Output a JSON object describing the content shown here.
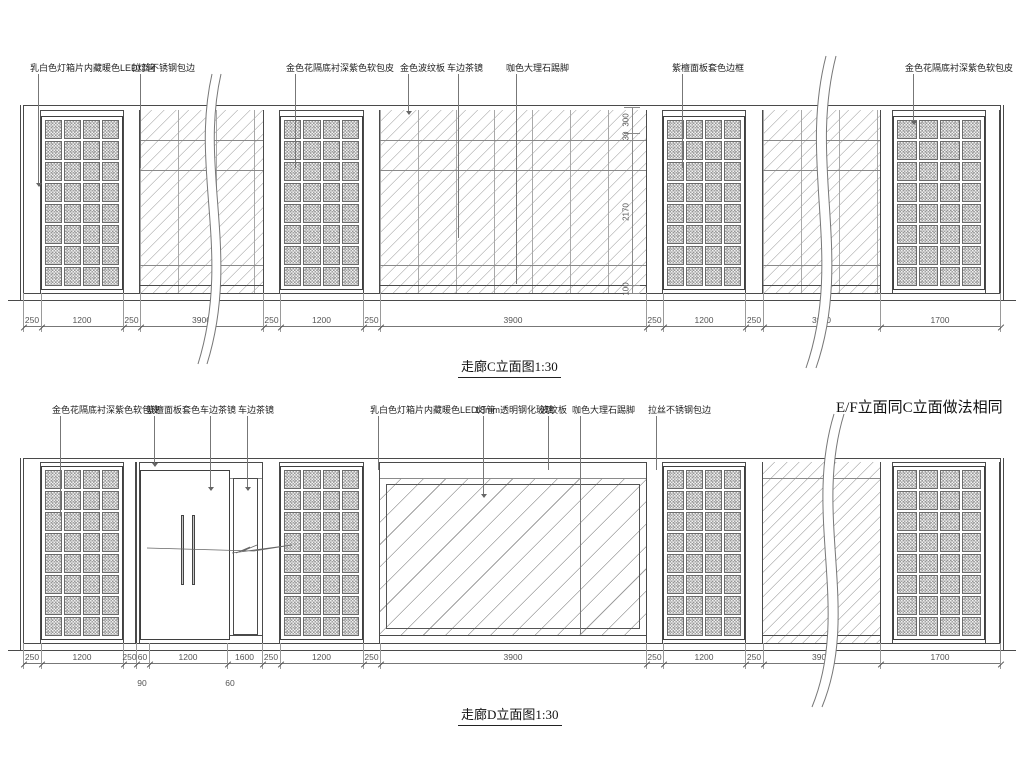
{
  "note_ef": "E/F立面同C立面做法相同",
  "drawing_c": {
    "title": "走廊C立面图1:30",
    "labels": [
      "乳白色灯箱片内藏暖色LED灯管",
      "拉丝不锈钢包边",
      "金色花隔底衬深紫色软包皮",
      "金色波纹板",
      "车边茶镜",
      "咖色大理石踢脚",
      "紫檀面板套色边框",
      "金色花隔底衬深紫色软包皮"
    ],
    "dims": [
      "250",
      "1200",
      "250",
      "3900",
      "250",
      "1200",
      "250",
      "3900",
      "250",
      "1200",
      "250",
      "3900",
      "1700"
    ],
    "vdims": [
      "300",
      "30",
      "2170",
      "100"
    ]
  },
  "drawing_d": {
    "title": "走廊D立面图1:30",
    "labels": [
      "金色花隔底衬深紫色软包皮",
      "紫檀面板套色",
      "车边茶镜",
      "车边茶镜",
      "乳白色灯箱片内藏暖色LED灯管",
      "18mm透明钢化玻璃",
      "波纹板",
      "咖色大理石踢脚",
      "拉丝不锈钢包边"
    ],
    "dims": [
      "250",
      "1200",
      "250",
      "60",
      "1200",
      "1600",
      "250",
      "1200",
      "250",
      "3900",
      "250",
      "1200",
      "250",
      "3900",
      "1700"
    ],
    "sub_dims": [
      "90",
      "60"
    ]
  },
  "colors": {
    "line": "#4a4a4a",
    "hatch": "#9c9c9c",
    "text": "#1f1f1f",
    "dim_text": "#555555"
  }
}
